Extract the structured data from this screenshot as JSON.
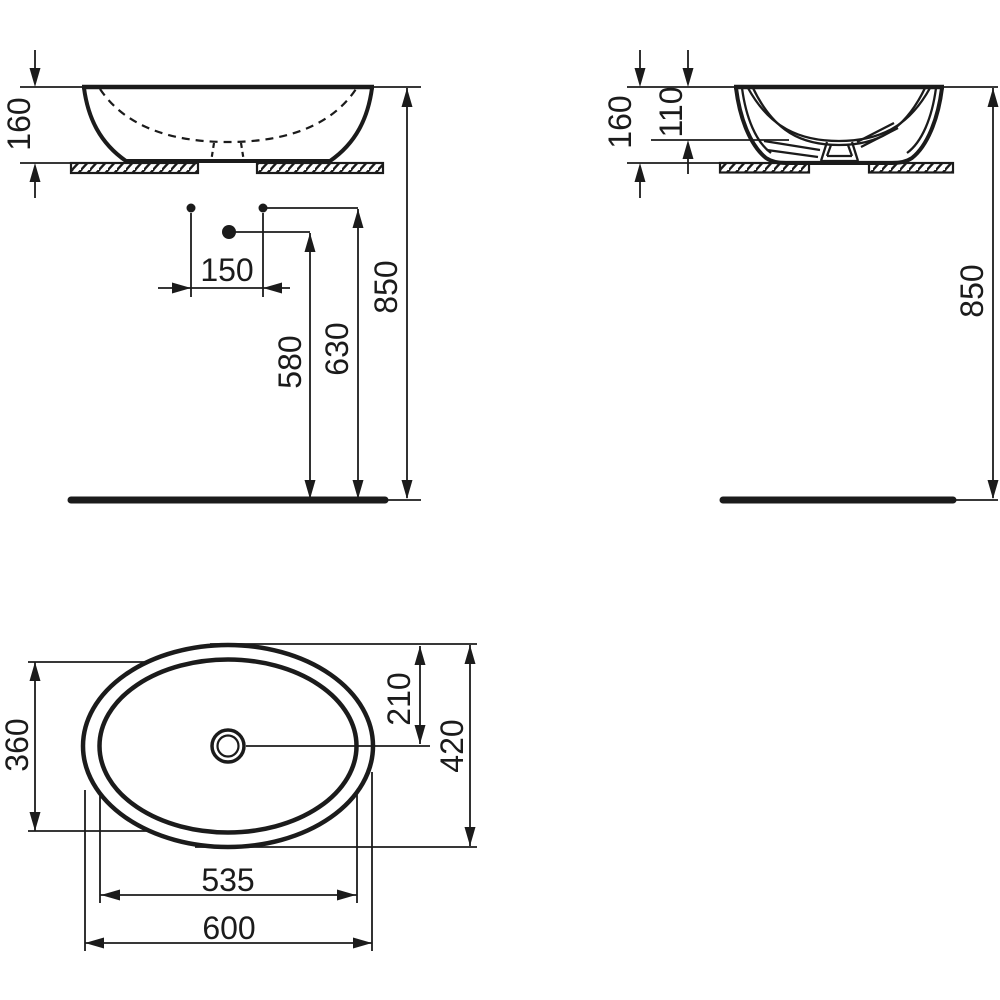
{
  "drawing": {
    "colors": {
      "ink": "#1b1b1b",
      "background": "#ffffff"
    },
    "views": {
      "front": {
        "dims": {
          "basin_height": "160",
          "tap_hole_spacing": "150",
          "drain_outlet_height": "580",
          "supply_height": "630",
          "rim_height": "850"
        }
      },
      "side": {
        "dims": {
          "basin_height": "160",
          "bowl_depth": "110",
          "rim_height": "850"
        }
      },
      "top": {
        "dims": {
          "bowl_width": "360",
          "center_offset": "210",
          "overall_width": "420",
          "bowl_length": "535",
          "overall_length": "600"
        }
      }
    }
  }
}
